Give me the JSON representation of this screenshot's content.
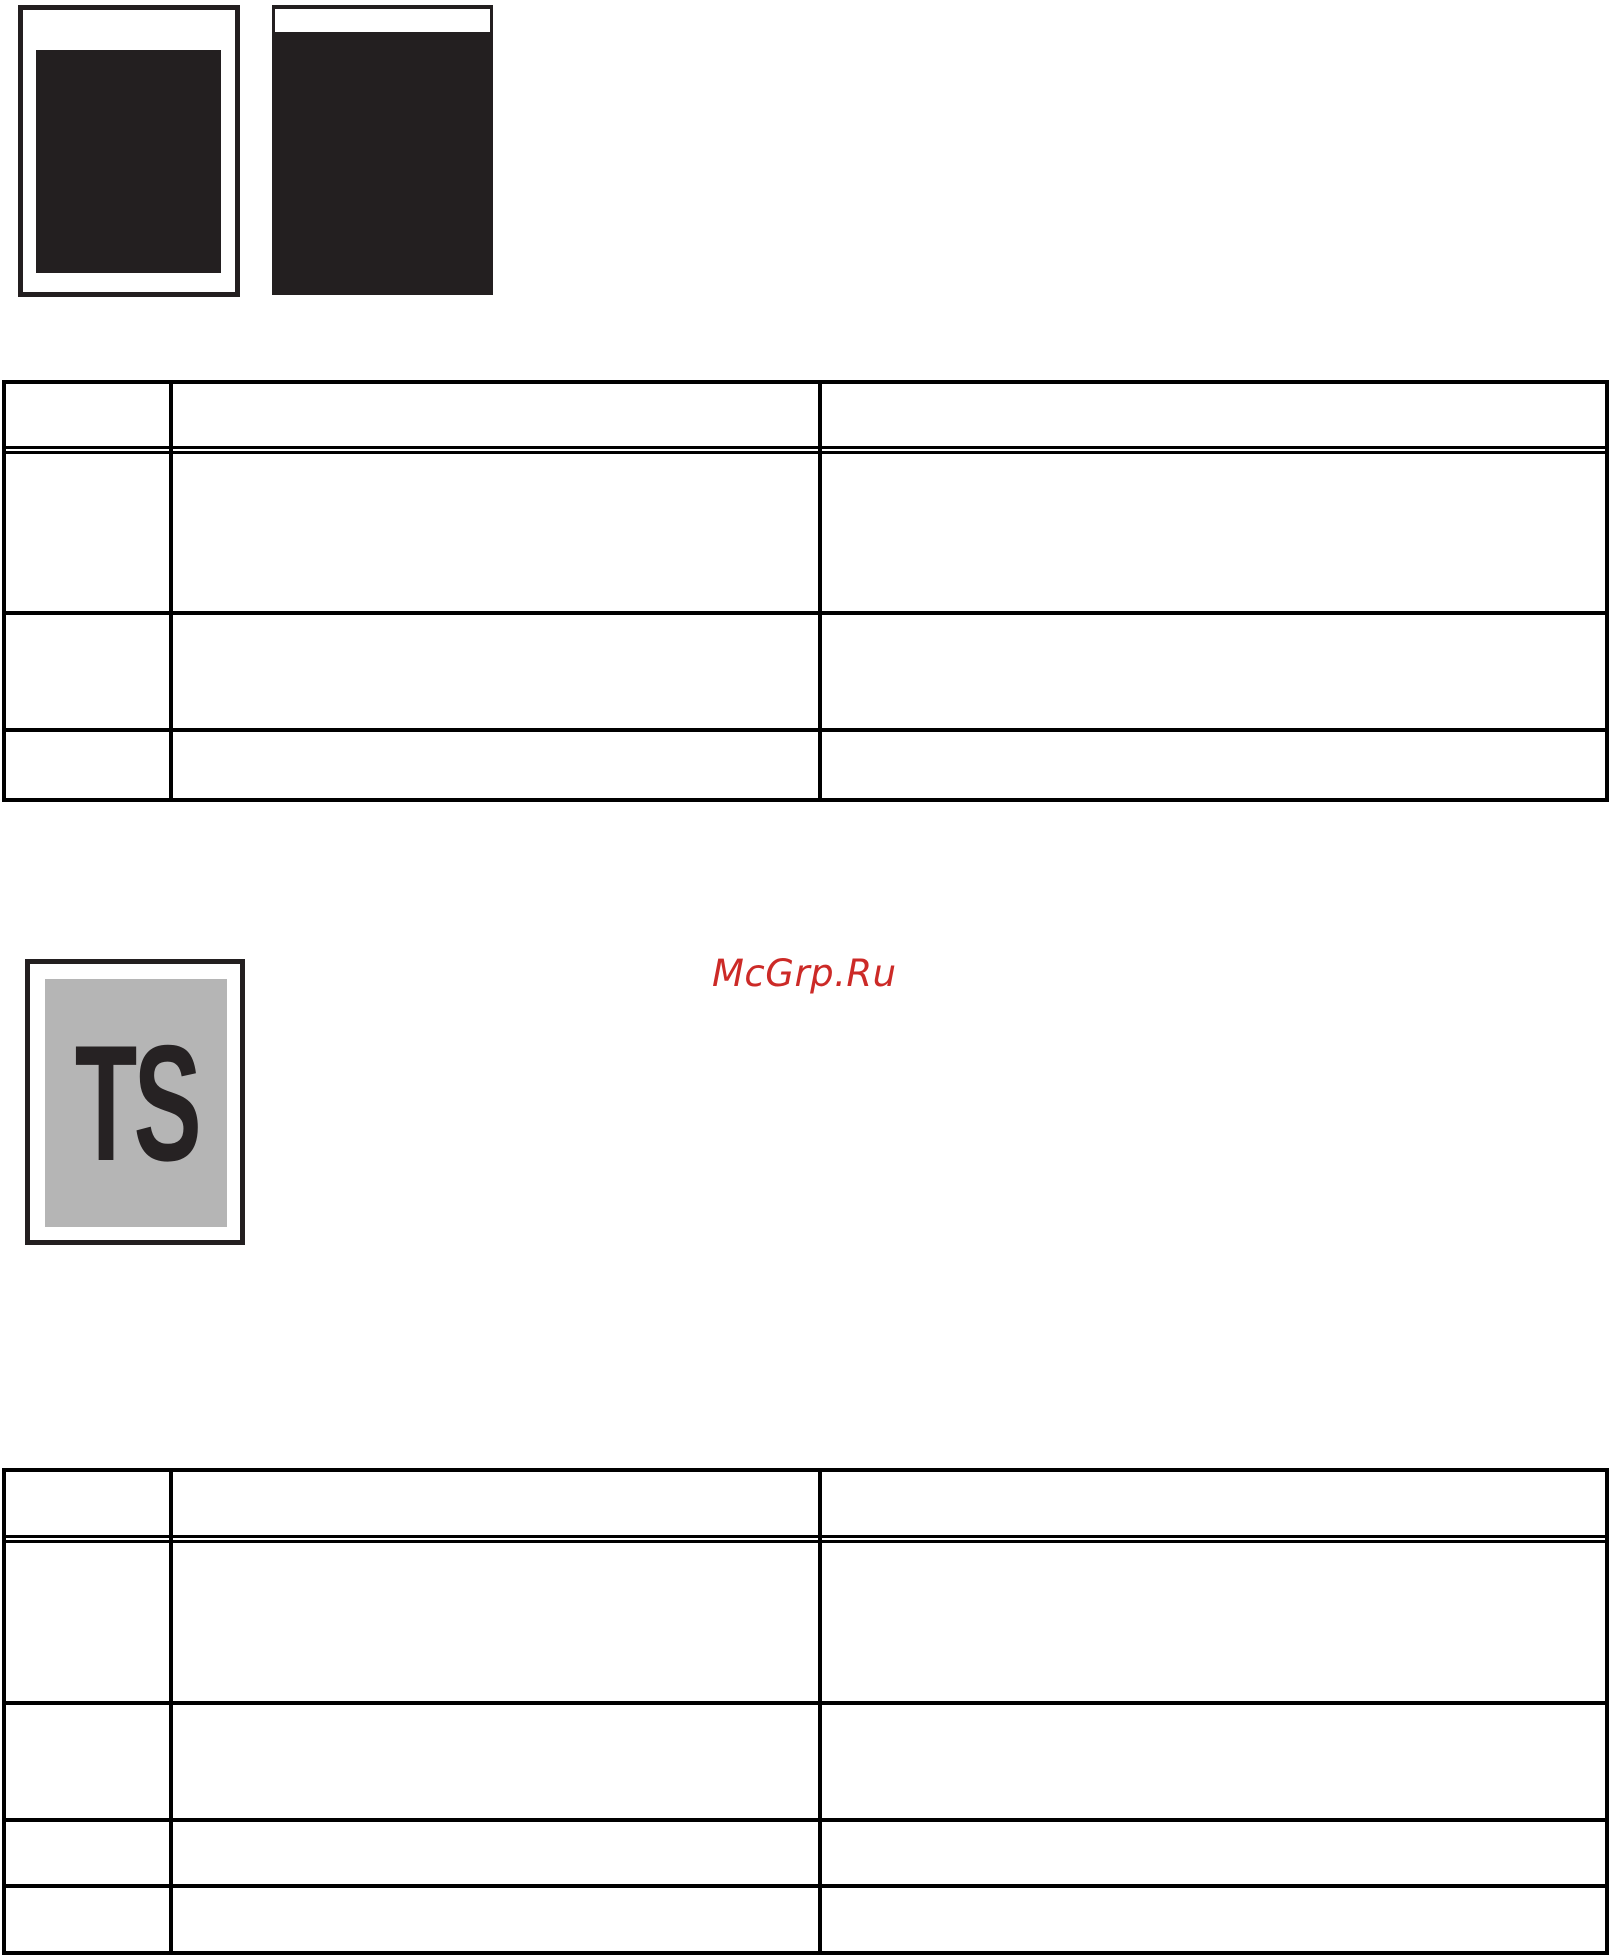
{
  "watermark": {
    "text": "McGrp.Ru",
    "color": "#cc2a27"
  },
  "test_page": {
    "label": "TS",
    "label_color": "#262223",
    "page_gray": "#b5b5b5"
  },
  "print_samples": {
    "ink_color": "#231f20",
    "sample_count": 2
  },
  "table_style": {
    "border_color": "#000000",
    "header_separator": "double-line"
  },
  "tables": {
    "first": {
      "header": [
        "",
        "",
        ""
      ],
      "rows": [
        [
          "",
          "",
          ""
        ],
        [
          "",
          "",
          ""
        ],
        [
          "",
          "",
          ""
        ]
      ]
    },
    "second": {
      "header": [
        "",
        "",
        ""
      ],
      "rows": [
        [
          "",
          "",
          ""
        ],
        [
          "",
          "",
          ""
        ],
        [
          "",
          "",
          ""
        ],
        [
          "",
          "",
          ""
        ]
      ]
    }
  }
}
